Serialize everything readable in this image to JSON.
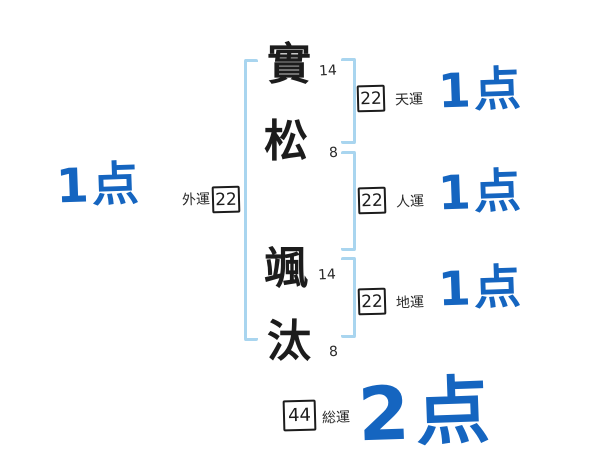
{
  "diagram_type": "name-fortune-diagram",
  "name_chars": [
    {
      "char": "實",
      "strokes": "14"
    },
    {
      "char": "松",
      "strokes": "8"
    },
    {
      "char": "颯",
      "strokes": "14"
    },
    {
      "char": "汰",
      "strokes": "8"
    }
  ],
  "fortunes": {
    "ten": {
      "label": "天運",
      "value": "22",
      "score": "1点"
    },
    "jin": {
      "label": "人運",
      "value": "22",
      "score": "1点"
    },
    "chi": {
      "label": "地運",
      "value": "22",
      "score": "1点"
    },
    "gai": {
      "label": "外運",
      "value": "22",
      "score": "1点"
    },
    "sou": {
      "label": "総運",
      "value": "44",
      "score": "2点"
    }
  },
  "colors": {
    "score_blue": "#1565c0",
    "bracket_blue": "#a9d5ef",
    "ink": "#1c1c1c",
    "background": "#ffffff"
  }
}
